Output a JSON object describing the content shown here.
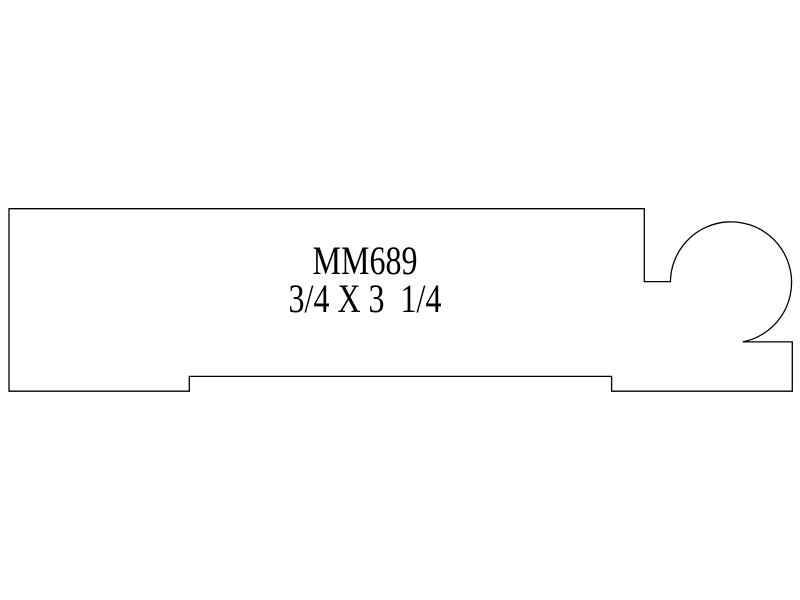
{
  "colors": {
    "background": "#ffffff",
    "line": "#000000",
    "text": "#000000"
  },
  "drawing": {
    "product_code": "MM689",
    "size_label": "3/4 X 3  1/4",
    "profile_path": "M 9 208.7 L 644.3 208.7 L 644.3 281.6 L 670.4 281.6 A 60.6 60.6 0 1 1 742.8 341.9 L 792.3 341.9 L 792.3 391.2 L 611.6 391.2 L 611.6 376.4 L 189.3 376.4 L 189.3 391.2 L 9 391.2 Z"
  }
}
